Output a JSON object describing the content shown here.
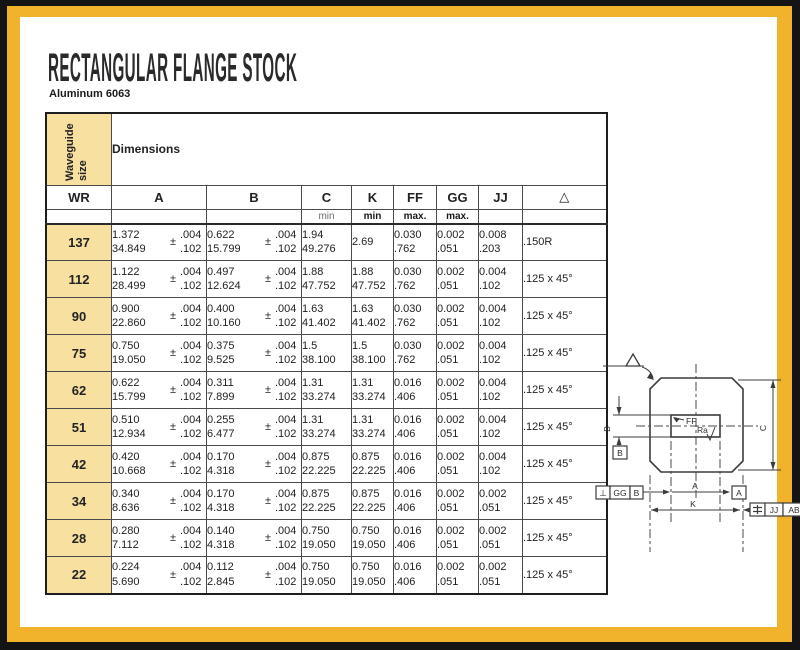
{
  "page": {
    "title": "RECTANGULAR FLANGE STOCK",
    "subtitle": "Aluminum 6063",
    "colors": {
      "frame_black": "#141414",
      "frame_gold": "#F0B32B",
      "header_yellow": "#F7E0A0"
    }
  },
  "table": {
    "corner_header": "Waveguide size",
    "dimensions_header": "Dimensions",
    "columns": [
      "WR",
      "A",
      "B",
      "C",
      "K",
      "FF",
      "GG",
      "JJ",
      "△"
    ],
    "subheaders": {
      "c": "min",
      "k": "min",
      "ff": "max.",
      "gg": "max."
    },
    "plus_minus": "±",
    "rows": [
      {
        "wr": "137",
        "a_in": "1.372",
        "a_mm": "34.849",
        "a_tol_in": ".004",
        "a_tol_mm": ".102",
        "b_in": "0.622",
        "b_mm": "15.799",
        "b_tol_in": ".004",
        "b_tol_mm": ".102",
        "c_in": "1.94",
        "c_mm": "49.276",
        "k_in": "2.69",
        "k_mm": "",
        "ff_in": "0.030",
        "ff_mm": ".762",
        "gg_in": "0.002",
        "gg_mm": ".051",
        "jj_in": "0.008",
        "jj_mm": ".203",
        "corner": ".150R"
      },
      {
        "wr": "112",
        "a_in": "1.122",
        "a_mm": "28.499",
        "a_tol_in": ".004",
        "a_tol_mm": ".102",
        "b_in": "0.497",
        "b_mm": "12.624",
        "b_tol_in": ".004",
        "b_tol_mm": ".102",
        "c_in": "1.88",
        "c_mm": "47.752",
        "k_in": "1.88",
        "k_mm": "47.752",
        "ff_in": "0.030",
        "ff_mm": ".762",
        "gg_in": "0.002",
        "gg_mm": ".051",
        "jj_in": "0.004",
        "jj_mm": ".102",
        "corner": ".125 x 45°"
      },
      {
        "wr": "90",
        "a_in": "0.900",
        "a_mm": "22.860",
        "a_tol_in": ".004",
        "a_tol_mm": ".102",
        "b_in": "0.400",
        "b_mm": "10.160",
        "b_tol_in": ".004",
        "b_tol_mm": ".102",
        "c_in": "1.63",
        "c_mm": "41.402",
        "k_in": "1.63",
        "k_mm": "41.402",
        "ff_in": "0.030",
        "ff_mm": ".762",
        "gg_in": "0.002",
        "gg_mm": ".051",
        "jj_in": "0.004",
        "jj_mm": ".102",
        "corner": ".125 x 45°"
      },
      {
        "wr": "75",
        "a_in": "0.750",
        "a_mm": "19.050",
        "a_tol_in": ".004",
        "a_tol_mm": ".102",
        "b_in": "0.375",
        "b_mm": "9.525",
        "b_tol_in": ".004",
        "b_tol_mm": ".102",
        "c_in": "1.5",
        "c_mm": "38.100",
        "k_in": "1.5",
        "k_mm": "38.100",
        "ff_in": "0.030",
        "ff_mm": ".762",
        "gg_in": "0.002",
        "gg_mm": ".051",
        "jj_in": "0.004",
        "jj_mm": ".102",
        "corner": ".125 x 45°"
      },
      {
        "wr": "62",
        "a_in": "0.622",
        "a_mm": "15.799",
        "a_tol_in": ".004",
        "a_tol_mm": ".102",
        "b_in": "0.311",
        "b_mm": "7.899",
        "b_tol_in": ".004",
        "b_tol_mm": ".102",
        "c_in": "1.31",
        "c_mm": "33.274",
        "k_in": "1.31",
        "k_mm": "33.274",
        "ff_in": "0.016",
        "ff_mm": ".406",
        "gg_in": "0.002",
        "gg_mm": ".051",
        "jj_in": "0.004",
        "jj_mm": ".102",
        "corner": ".125 x 45°"
      },
      {
        "wr": "51",
        "a_in": "0.510",
        "a_mm": "12.934",
        "a_tol_in": ".004",
        "a_tol_mm": ".102",
        "b_in": "0.255",
        "b_mm": "6.477",
        "b_tol_in": ".004",
        "b_tol_mm": ".102",
        "c_in": "1.31",
        "c_mm": "33.274",
        "k_in": "1.31",
        "k_mm": "33.274",
        "ff_in": "0.016",
        "ff_mm": ".406",
        "gg_in": "0.002",
        "gg_mm": ".051",
        "jj_in": "0.004",
        "jj_mm": ".102",
        "corner": ".125 x 45°"
      },
      {
        "wr": "42",
        "a_in": "0.420",
        "a_mm": "10.668",
        "a_tol_in": ".004",
        "a_tol_mm": ".102",
        "b_in": "0.170",
        "b_mm": "4.318",
        "b_tol_in": ".004",
        "b_tol_mm": ".102",
        "c_in": "0.875",
        "c_mm": "22.225",
        "k_in": "0.875",
        "k_mm": "22.225",
        "ff_in": "0.016",
        "ff_mm": ".406",
        "gg_in": "0.002",
        "gg_mm": ".051",
        "jj_in": "0.004",
        "jj_mm": ".102",
        "corner": ".125 x 45°"
      },
      {
        "wr": "34",
        "a_in": "0.340",
        "a_mm": "8.636",
        "a_tol_in": ".004",
        "a_tol_mm": ".102",
        "b_in": "0.170",
        "b_mm": "4.318",
        "b_tol_in": ".004",
        "b_tol_mm": ".102",
        "c_in": "0.875",
        "c_mm": "22.225",
        "k_in": "0.875",
        "k_mm": "22.225",
        "ff_in": "0.016",
        "ff_mm": ".406",
        "gg_in": "0.002",
        "gg_mm": ".051",
        "jj_in": "0.002",
        "jj_mm": ".051",
        "corner": ".125 x 45°"
      },
      {
        "wr": "28",
        "a_in": "0.280",
        "a_mm": "7.112",
        "a_tol_in": ".004",
        "a_tol_mm": ".102",
        "b_in": "0.140",
        "b_mm": "4.318",
        "b_tol_in": ".004",
        "b_tol_mm": ".102",
        "c_in": "0.750",
        "c_mm": "19.050",
        "k_in": "0.750",
        "k_mm": "19.050",
        "ff_in": "0.016",
        "ff_mm": ".406",
        "gg_in": "0.002",
        "gg_mm": ".051",
        "jj_in": "0.002",
        "jj_mm": ".051",
        "corner": ".125 x 45°"
      },
      {
        "wr": "22",
        "a_in": "0.224",
        "a_mm": "5.690",
        "a_tol_in": ".004",
        "a_tol_mm": ".102",
        "b_in": "0.112",
        "b_mm": "2.845",
        "b_tol_in": ".004",
        "b_tol_mm": ".102",
        "c_in": "0.750",
        "c_mm": "19.050",
        "k_in": "0.750",
        "k_mm": "19.050",
        "ff_in": "0.016",
        "ff_mm": ".406",
        "gg_in": "0.002",
        "gg_mm": ".051",
        "jj_in": "0.002",
        "jj_mm": ".051",
        "corner": ".125 x 45°"
      }
    ]
  },
  "diagram": {
    "labels": {
      "ff": "FF",
      "ra": "Ra",
      "b": "B",
      "c": "C",
      "a": "A",
      "k": "K"
    },
    "datums": {
      "a": "A",
      "b": "B"
    },
    "symbols": {
      "corner_chamfer": "△",
      "perpendicularity": "⊥",
      "symmetry": "⌯"
    },
    "fcf_perpendicularity": {
      "tolerance": "GG",
      "datum": "B"
    },
    "fcf_symmetry": {
      "tolerance": "JJ",
      "datum": "AB"
    }
  }
}
